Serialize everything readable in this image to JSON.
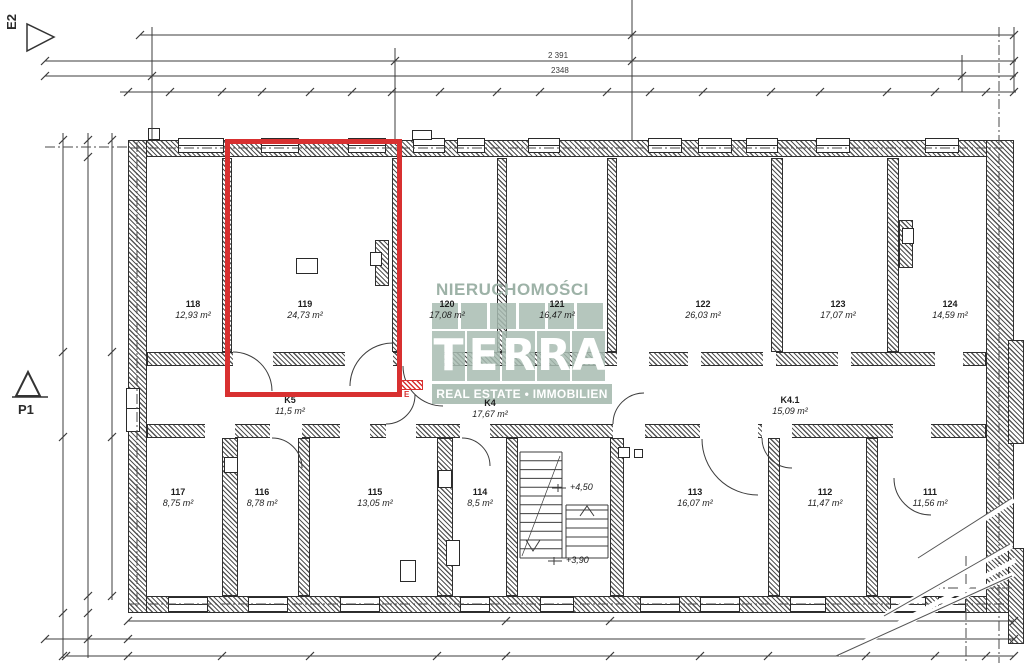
{
  "plan": {
    "markers": {
      "e2": "E2",
      "p1": "P1"
    },
    "dims": {
      "total_width": "2 391",
      "inner_width": "2348"
    },
    "levels": [
      {
        "text": "+4,50"
      },
      {
        "text": "+3,90"
      }
    ],
    "electrical_label": "E",
    "watermark": {
      "line1": "NIERUCHOMOŚCI",
      "logo": "TERRA",
      "line2": "REAL ESTATE • IMMOBILIEN",
      "color": "#a8bcb1"
    },
    "highlight_color": "#d83030",
    "rooms_upper": [
      {
        "number": "118",
        "area": "12,93 m²"
      },
      {
        "number": "119",
        "area": "24,73 m²"
      },
      {
        "number": "120",
        "area": "17,08 m²"
      },
      {
        "number": "121",
        "area": "16,47 m²"
      },
      {
        "number": "122",
        "area": "26,03 m²"
      },
      {
        "number": "123",
        "area": "17,07 m²"
      },
      {
        "number": "124",
        "area": "14,59 m²"
      }
    ],
    "corridors": [
      {
        "number": "K5",
        "area": "11,5 m²"
      },
      {
        "number": "K4",
        "area": "17,67 m²"
      },
      {
        "number": "K4.1",
        "area": "15,09 m²"
      }
    ],
    "rooms_lower": [
      {
        "number": "117",
        "area": "8,75 m²"
      },
      {
        "number": "116",
        "area": "8,78 m²"
      },
      {
        "number": "115",
        "area": "13,05 m²"
      },
      {
        "number": "114",
        "area": "8,5 m²"
      },
      {
        "number": "113",
        "area": "16,07 m²"
      },
      {
        "number": "112",
        "area": "11,47 m²"
      },
      {
        "number": "111",
        "area": "11,56 m²"
      }
    ]
  }
}
